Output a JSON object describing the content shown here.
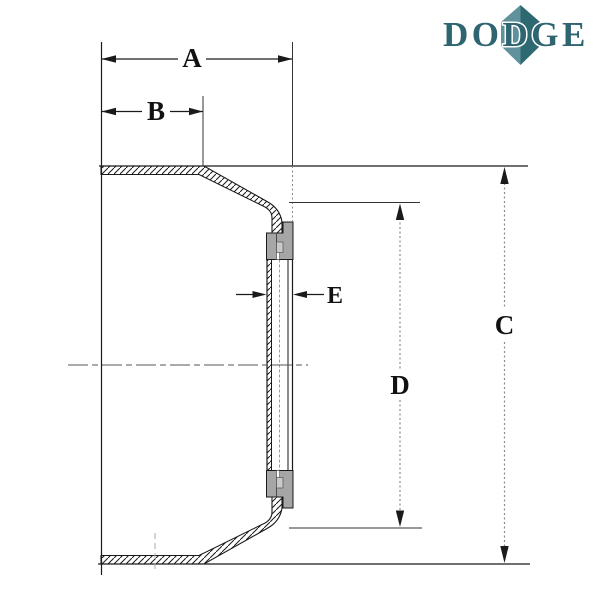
{
  "logo": {
    "text": "DODGE",
    "color": "#2e6571",
    "diamond_light": "#5f929b",
    "diamond_dark": "#2e6871"
  },
  "labels": {
    "a": "A",
    "b": "B",
    "c": "C",
    "d": "D",
    "e": "E"
  },
  "colors": {
    "line": "#1a1a1a",
    "dim_gray": "#8a8a8a",
    "hub_gray": "#a6a6a6",
    "recess_gray": "#c9c9c9"
  }
}
